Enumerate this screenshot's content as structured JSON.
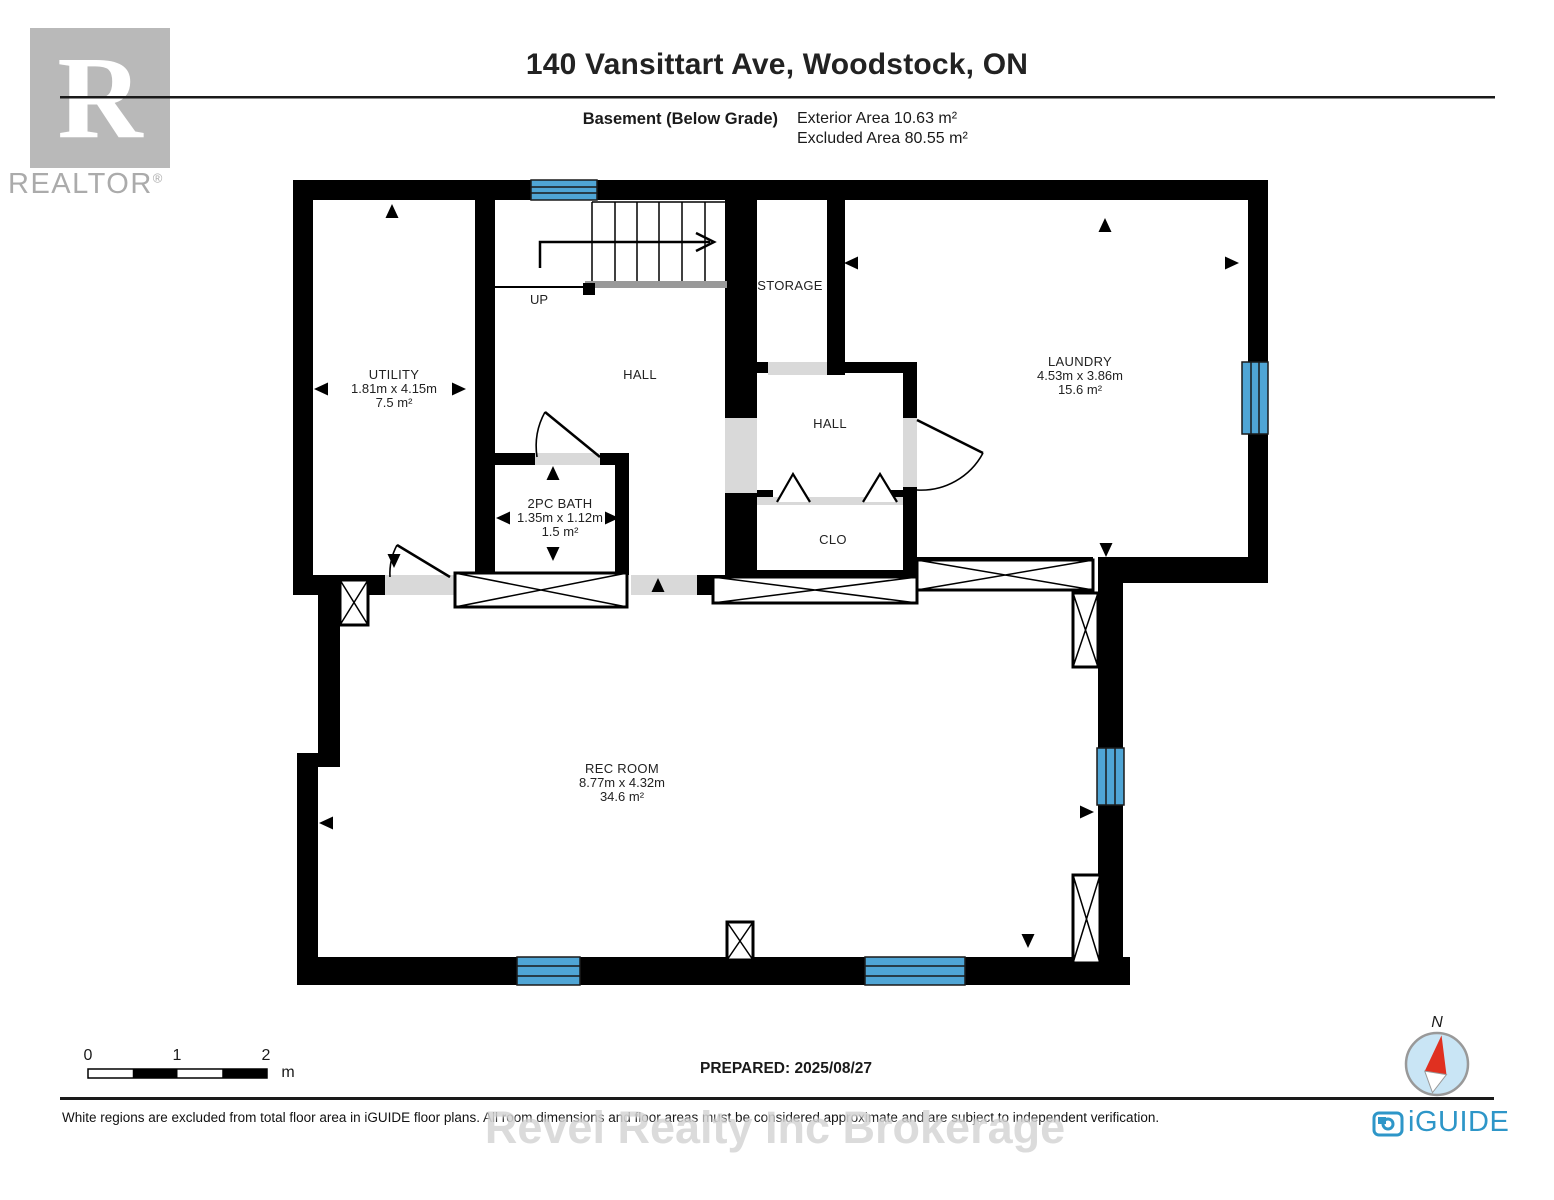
{
  "header": {
    "title": "140 Vansittart Ave, Woodstock, ON",
    "floor_label": "Basement (Below Grade)",
    "exterior_area": "Exterior Area 10.63 m²",
    "excluded_area": "Excluded Area 80.55 m²"
  },
  "branding": {
    "realtor_logo_letter": "R",
    "realtor_word": "REALTOR",
    "realtor_reg": "®",
    "iguide_word": "iGUIDE",
    "watermark": "Revel Realty Inc Brokerage"
  },
  "rooms": {
    "utility": {
      "name": "UTILITY",
      "dims": "1.81m x 4.15m",
      "area": "7.5 m²"
    },
    "hall_upper": {
      "name": "HALL"
    },
    "storage": {
      "name": "STORAGE"
    },
    "laundry": {
      "name": "LAUNDRY",
      "dims": "4.53m x 3.86m",
      "area": "15.6 m²"
    },
    "bath": {
      "name": "2PC BATH",
      "dims": "1.35m x 1.12m",
      "area": "1.5 m²"
    },
    "hall_center": {
      "name": "HALL"
    },
    "closet": {
      "name": "CLO"
    },
    "rec_room": {
      "name": "REC ROOM",
      "dims": "8.77m x 4.32m",
      "area": "34.6 m²"
    }
  },
  "stairs": {
    "direction_label": "UP"
  },
  "footer": {
    "scale": {
      "tick0": "0",
      "tick1": "1",
      "tick2": "2",
      "unit": "m"
    },
    "prepared": "PREPARED: 2025/08/27",
    "compass_label": "N",
    "disclaimer": "White regions are excluded from total floor area in iGUIDE floor plans. All room dimensions and floor areas must be considered approximate and are subject to independent verification."
  },
  "colors": {
    "wall": "#000000",
    "window": "#4FA5D5",
    "opening": "#D9D9D9",
    "landing": "#999999",
    "iguide_blue": "#2E96C8",
    "compass_fill": "#C9E5F5",
    "needle_red": "#E03020"
  }
}
